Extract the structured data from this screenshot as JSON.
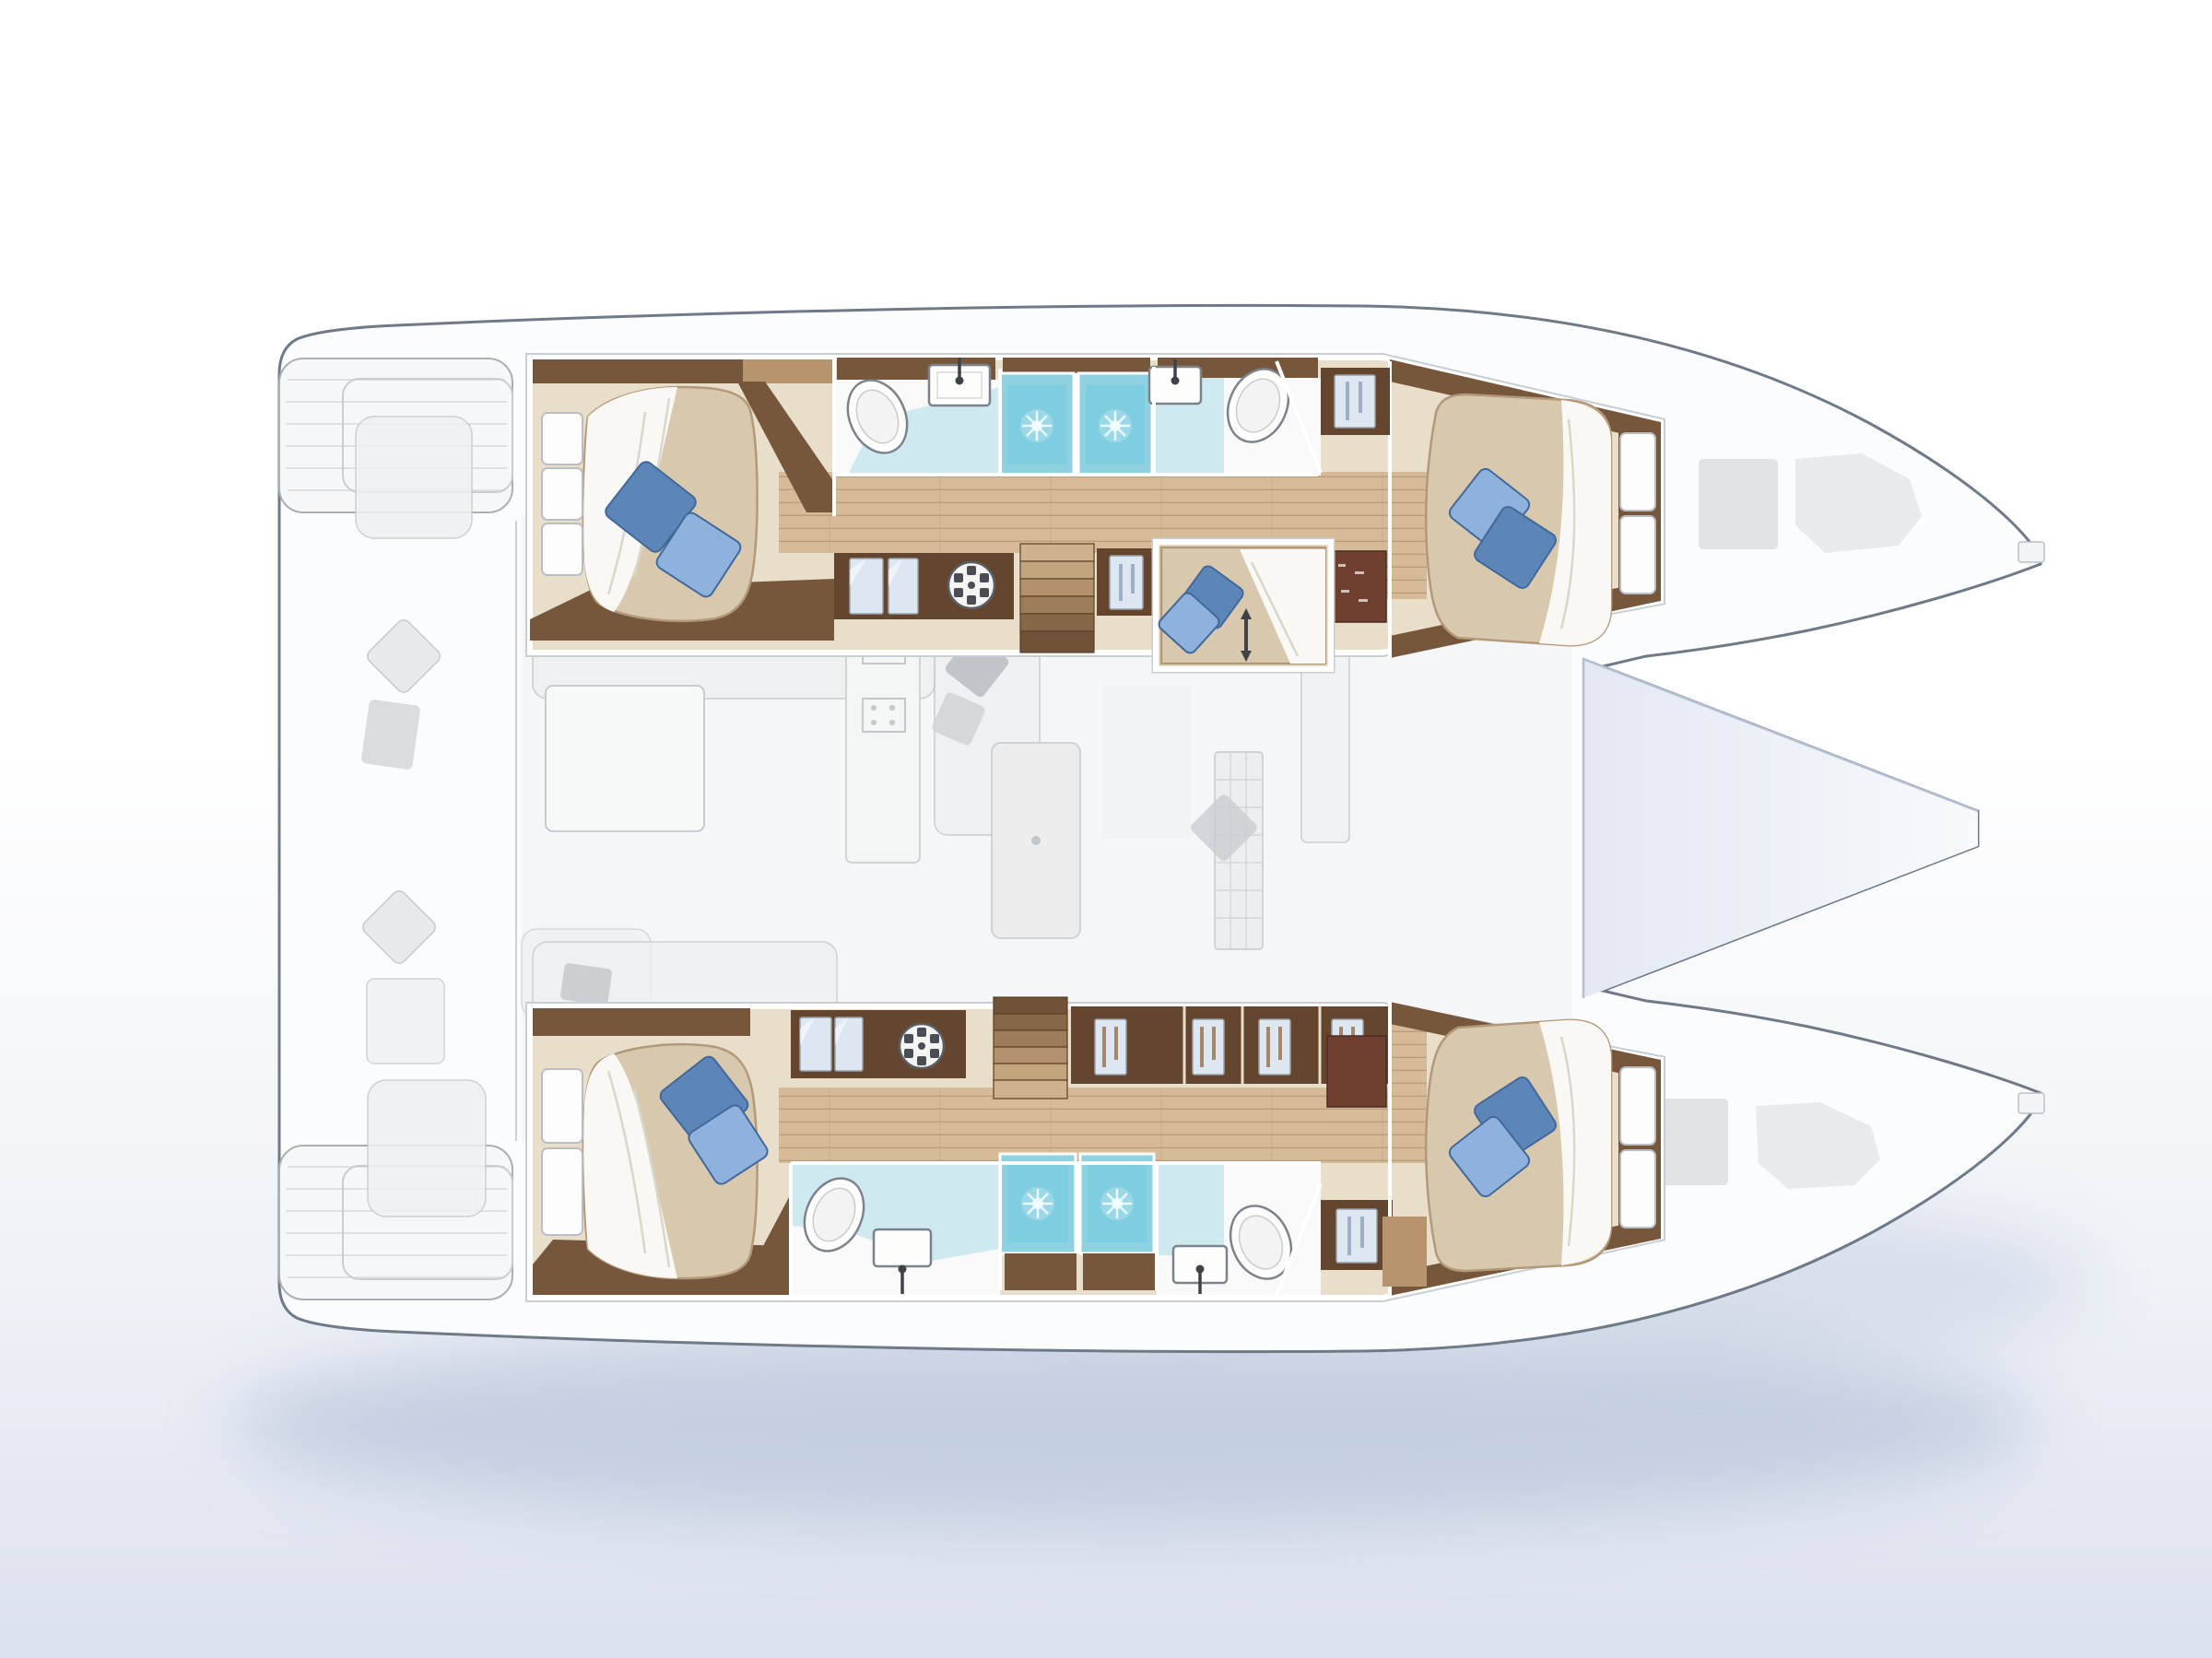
{
  "palette": {
    "bg_top": "#ffffff",
    "bg_mid": "#eef1f6",
    "bg_bottom": "#dbe1ee",
    "hull_fill": "#fbfcfd",
    "hull_stroke": "#6e7a87",
    "shadow": "#a4b4d0",
    "deck_ghost_fill": "#efF0f1",
    "deck_ghost_stroke": "#c6cacd",
    "ghost_dark": "#b9bdc2",
    "foredeck_left": "#e3e8f2",
    "foredeck_right": "#f7f9fc",
    "foredeck_edge": "#b3bfd0",
    "wood_light": "#d5bb97",
    "wood_mid": "#b5946e",
    "wood_dark": "#77573c",
    "wood_deep": "#64462f",
    "wood_red": "#6f4030",
    "floor_beige": "#e9deca",
    "mattress": "#d8c9ae",
    "mattress_edge": "#b2997a",
    "duvet": "#f9f8f4",
    "duvet_line": "#d9d6cc",
    "pillow_light": "#8fb2dc",
    "pillow_dark": "#5d86b8",
    "pillow_stroke": "#42689a",
    "aqua_light": "#cfe9f1",
    "aqua_bright": "#8ed2e2",
    "aqua_deep": "#5ec3dc",
    "bath_white": "#f8f9f8",
    "fixture_stroke": "#7c838a",
    "fixture_dark": "#3f4348",
    "frame_white": "#ffffff",
    "door_glass": "#dce7f2",
    "garment": "#a5876a",
    "garment_blue": "#9fb0c6"
  },
  "icons": {
    "shower_spray": "starburst",
    "washing_machine": "spoked-circle",
    "wardrobe_door": "hanging-garment-panel",
    "mirror_door": "glass-reflection-panel",
    "faucet": "stem-with-round-head",
    "toilet": "tilted-oval-bowl",
    "berth_access_arrow": "double-headed-vertical-arrow",
    "transom_steps": "slatted-platform",
    "stairs": "laddered-treads"
  },
  "features": {
    "hulls": 2,
    "double_cabins": 4,
    "mid_berth_cabins": 1,
    "shower_stalls": 4,
    "toilets": 4,
    "washbasins": 4,
    "washing_machines": 2,
    "staircases": 2,
    "transom_platforms": 2,
    "blue_accent_pillows": 10,
    "ghosted_upper_deck": [
      "cockpit",
      "salon-sofa",
      "salon-table",
      "galley",
      "island",
      "fridge",
      "foredeck"
    ]
  }
}
